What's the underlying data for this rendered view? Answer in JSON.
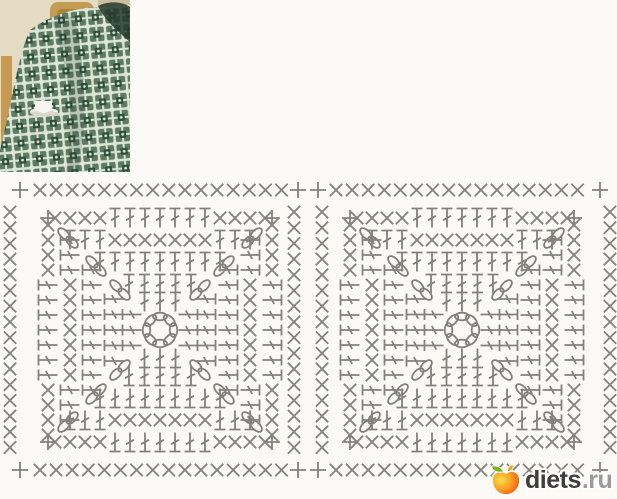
{
  "page": {
    "background": "#fbfaf6"
  },
  "photo": {
    "colors": {
      "backdrop": "#e4dbc5",
      "wall_shadow": "#ccbf9f",
      "wood": "#c59a52",
      "wood_dark": "#97702f",
      "square_light": "#dde7d5",
      "square_mid": "#5d7a62",
      "square_dark": "#30503c",
      "fold_shadow": "#24382a",
      "cup": "#f7f5ef",
      "cup_shadow": "#bcb8a6"
    }
  },
  "diagram": {
    "stroke": "#82817b",
    "stroke_width": 1.8,
    "motifs": [
      {
        "cx": 160,
        "cy": 330
      },
      {
        "cx": 462,
        "cy": 330
      }
    ],
    "motif": {
      "center_ring": {
        "count": 8,
        "radius": 13.5,
        "oval_rx": 7,
        "oval_ry": 3.8
      },
      "rounds": [
        {
          "h": 28,
          "step": 15.5,
          "pattern": "ddd"
        },
        {
          "h": 46,
          "step": 15.5,
          "pattern": "ddddd"
        },
        {
          "h": 68,
          "step": 15,
          "pattern": "ddddddddd"
        },
        {
          "h": 90,
          "step": 15,
          "pattern": "dddxxxxxxxddd"
        },
        {
          "h": 112,
          "step": 15,
          "pattern": "xxxxdddddddxxxx"
        }
      ],
      "corner_plus_offset": 112,
      "corner_chain_offsets": [
        40,
        64,
        92
      ]
    },
    "edging": {
      "rows_y": [
        190,
        470
      ],
      "row_plus_x": [
        20,
        298,
        318,
        600
      ],
      "row_segments": [
        {
          "x0": 40,
          "x1": 282,
          "step": 16.1
        },
        {
          "x0": 336,
          "x1": 580,
          "step": 16.1
        }
      ],
      "columns_x": [
        10,
        294,
        322,
        610
      ],
      "col_y0": 212,
      "col_y1": 448,
      "col_step": 15.7
    }
  },
  "logo": {
    "brand": "diets",
    "tld": ".ru",
    "text_color": "#3f3e3c",
    "tld_color": "#9c9b99",
    "apple": {
      "leaf": "#79b31e",
      "stem": "#f2a007",
      "body_light": "#f3e24d",
      "body_mid": "#ff9a1e",
      "body_dark": "#dd3512"
    }
  }
}
